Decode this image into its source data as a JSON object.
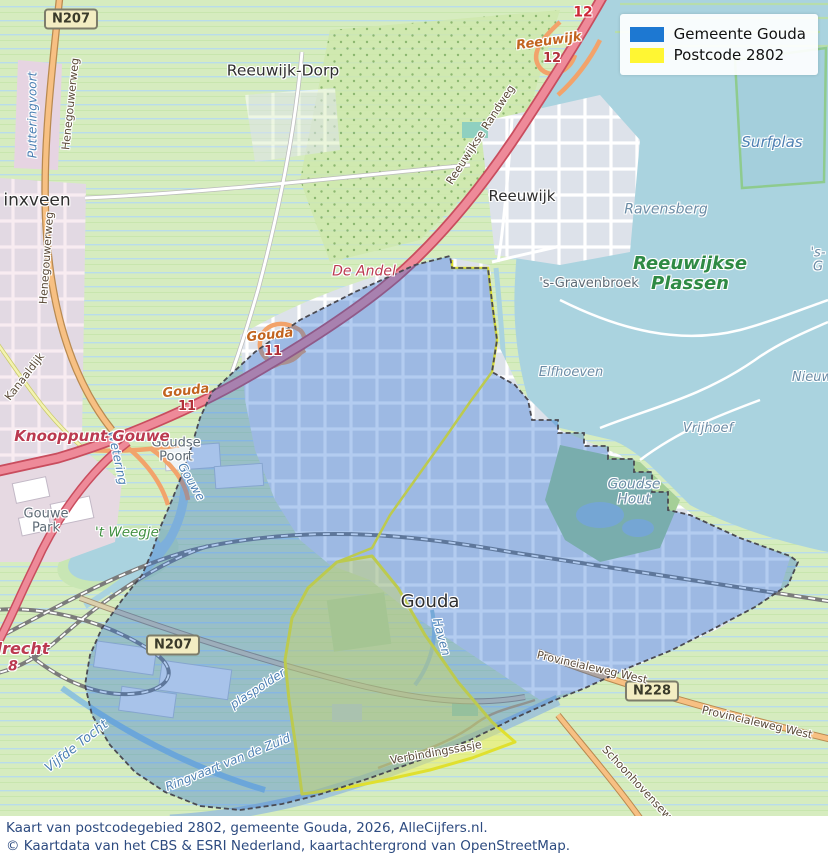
{
  "legend": {
    "items": [
      {
        "label": "Gemeente Gouda",
        "color": "#1d78d2"
      },
      {
        "label": "Postcode 2802",
        "color": "#fff633"
      }
    ]
  },
  "caption": {
    "line1": "Kaart van postcodegebied 2802, gemeente Gouda, 2026, AlleCijfers.nl.",
    "line2": "© Kaartdata van het CBS & ESRI Nederland, kaartachtergrond van OpenStreetMap."
  },
  "map": {
    "signs": {
      "n207_top": "N207",
      "n207_bottom": "N207",
      "n228": "N228"
    },
    "labels": {
      "reeuwijk_dorp": "Reeuwijk-Dorp",
      "waddinxveen": "inxveen",
      "reeuwijk": "Reeuwijk",
      "gouda": "Gouda",
      "goudse_poort": "Goudse\nPoort",
      "gouwe_park": "Gouwe\nPark",
      "gravenbroek": "'s-Gravenbroek",
      "weegje": "'t Weegje",
      "plassen": "Reeuwijkse\nPlassen",
      "ravensberg": "Ravensberg",
      "elfhoeven": "Elfhoeven",
      "vrijhoef": "Vrijhoef",
      "goudse_hout": "Goudse\nHout",
      "nieuw": "Nieuw",
      "sgrav_edge": "'s-G",
      "surfplas": "Surfplas",
      "putteringvoort": "Putteringvoort",
      "vijfde_tocht": "Vijfde Tocht",
      "ringvaart_1": "Ringvaart van de Zuid",
      "ringvaart_2": "plaspolder",
      "haven": "Haven",
      "wetering": "Wetering",
      "gouwe": "Gouwe",
      "reeuwijkse_randweg": "Reeuwijkse Randweg",
      "henegouwerweg_1": "Henegouwerweg",
      "henegouwerweg_2": "Henegouwerweg",
      "kanaaldijk": "Kanaaldijk",
      "provincialeweg_1": "Provincialeweg West",
      "provincialeweg_2": "Provincialeweg West",
      "schoonhovenseweg": "Schoonhovenseweg",
      "verbindingssasje": "Verbindingssasje",
      "knooppunt_gouwe": "Knooppunt Gouwe",
      "de_andel": "De Andel",
      "drecht": "drecht",
      "exit_8": "8",
      "a12_badge": "12",
      "exit_reeuwijk": "Reeuwijk",
      "exit_reeuwijk_num": "12",
      "exit_gouda_1": "Gouda",
      "exit_gouda_1_num": "11",
      "exit_gouda_2": "Gouda",
      "exit_gouda_2_num": "11"
    }
  },
  "colors": {
    "gemeente_overlay": "#1d78d2",
    "postcode_overlay": "#fff633",
    "water": "#aad3df",
    "motorway": "#e8717f",
    "primary_road": "#f7c083",
    "farmland": "#d6ecbf",
    "caption_text": "#2d4b80"
  }
}
